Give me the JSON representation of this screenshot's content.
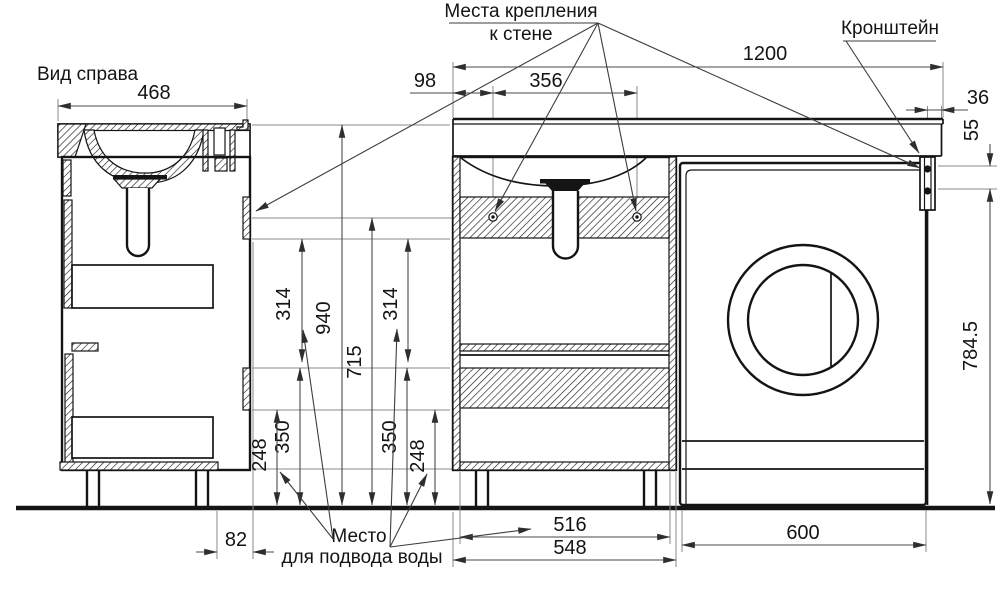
{
  "labels": {
    "view_right": "Вид справа",
    "wall_mount_1": "Места крепления",
    "wall_mount_2": "к стене",
    "bracket": "Кронштейн",
    "water_1": "Место",
    "water_2": "для подвода воды"
  },
  "dims": {
    "side_width": "468",
    "total_width": "1200",
    "wall_offset": "98",
    "mount_spacing": "356",
    "bracket_offset": "36",
    "bracket_screw_spacing": "55",
    "overall_height": "940",
    "mount_height": "715",
    "rail_gap_left": "314",
    "rail_gap_right": "314",
    "lower_rail_top_left": "350",
    "lower_rail_top_right": "350",
    "lower_rail_bottom_left": "248",
    "lower_rail_bottom_right": "248",
    "back_clearance": "82",
    "inner_width": "516",
    "cabinet_width": "548",
    "washer_width": "600",
    "washer_height": "784.5"
  }
}
